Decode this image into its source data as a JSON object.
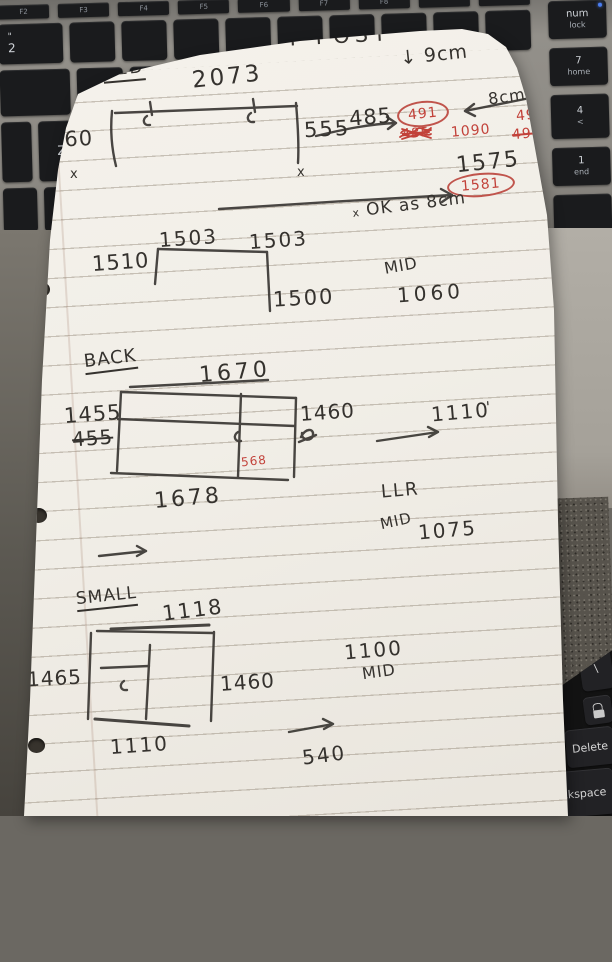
{
  "note": {
    "title": "T POST",
    "annotation_9cm": "↓ 9cm",
    "bed": {
      "label": "BED",
      "dim_top": "2073",
      "dim_left": "560",
      "dim_right": "555",
      "x_left": "x",
      "x_right": "x",
      "dim_485": "485",
      "circled_491": "491",
      "note_8cm": "8cm",
      "red_492": "492",
      "red_485_struck": "485",
      "red_1090": "1090",
      "red_492_struck": "492",
      "result_1575": "1575",
      "circled_1581": "1581",
      "ok_prefix": "x",
      "ok_note": "OK as 8cm"
    },
    "mattress": {
      "dim_top_a": "1503",
      "dim_top_b": "1503",
      "dim_left": "1510",
      "dim_right": "1500",
      "mid_label": "MID",
      "mid_value": "1060"
    },
    "back": {
      "label": "BACK",
      "dim_top": "1670",
      "dim_left": "1455",
      "dim_left_struck": "455",
      "dim_right": "1460",
      "note_1110": "1110",
      "tick_mark": "'",
      "red_568": "568",
      "dim_bottom": "1678",
      "llr_label": "LLR",
      "mid_label": "MID",
      "mid_value": "1075"
    },
    "small": {
      "label": "SMALL",
      "dim_top": "1118",
      "dim_left": "1465",
      "dim_right": "1460",
      "dim_bottom": "1110",
      "value_1100": "1100",
      "mid_label": "MID",
      "value_540": "540"
    }
  },
  "keyboard_top": {
    "fn_keys": [
      "F2",
      "F3",
      "F4",
      "F5",
      "F6",
      "F7",
      "F8"
    ],
    "key_2_shift": "\"",
    "key_2": "2",
    "key_z": "Z",
    "right_keys": [
      {
        "line1": "num",
        "line2": "lock"
      },
      {
        "line1": "7",
        "line2": "home"
      },
      {
        "line1": "4",
        "line2": "<"
      },
      {
        "line1": "1",
        "line2": "end"
      }
    ]
  },
  "keyboard_bottom": {
    "key_backslash": "\\",
    "key_delete": "Delete",
    "key_backspace": "ckspace"
  }
}
